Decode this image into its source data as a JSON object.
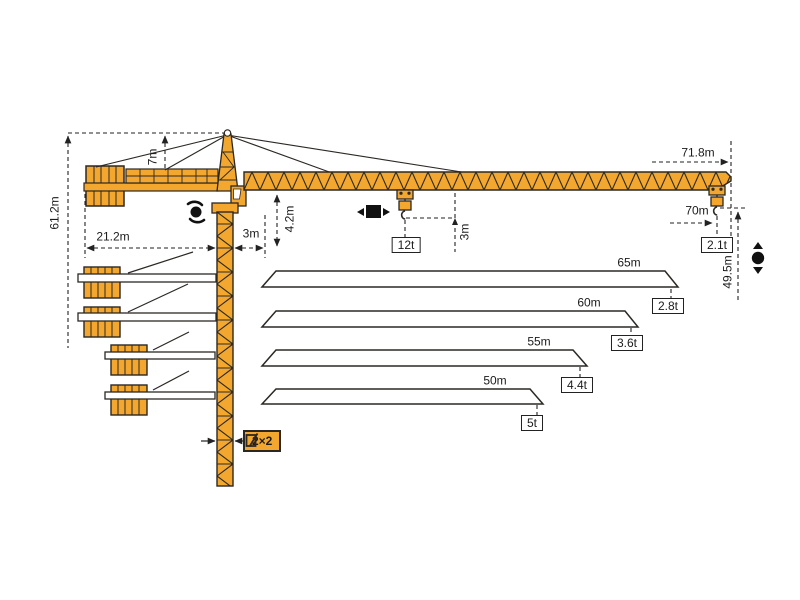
{
  "diagram": {
    "title": "tower-crane-dimension-and-jib-variant-diagram",
    "colors": {
      "crane_orange": "#f3a72f",
      "outline": "#2b2824",
      "dimension": "#222222",
      "background": "#ffffff"
    },
    "dimensions": {
      "total_height": "61.2m",
      "tower_head_height": "7m",
      "counter_radius": "21.2m",
      "slew_offset": "3m",
      "jib_root_height": "4.2m",
      "hook_clearance": "3m",
      "max_radius": "71.8m",
      "max_hook_radius": "70m",
      "hook_height_at_tip": "49.5m",
      "mast_section": "2×2"
    },
    "loads": {
      "max_capacity": "12t",
      "tip_load_full_jib": "2.1t"
    },
    "jib_variants": [
      {
        "length": "65m",
        "tip_load": "2.8t"
      },
      {
        "length": "60m",
        "tip_load": "3.6t"
      },
      {
        "length": "55m",
        "tip_load": "4.4t"
      },
      {
        "length": "50m",
        "tip_load": "5t"
      }
    ],
    "icons": [
      "slewing-rotation-icon",
      "trolley-travel-icon",
      "hoist-up-down-icon",
      "mast-section-icon"
    ]
  }
}
